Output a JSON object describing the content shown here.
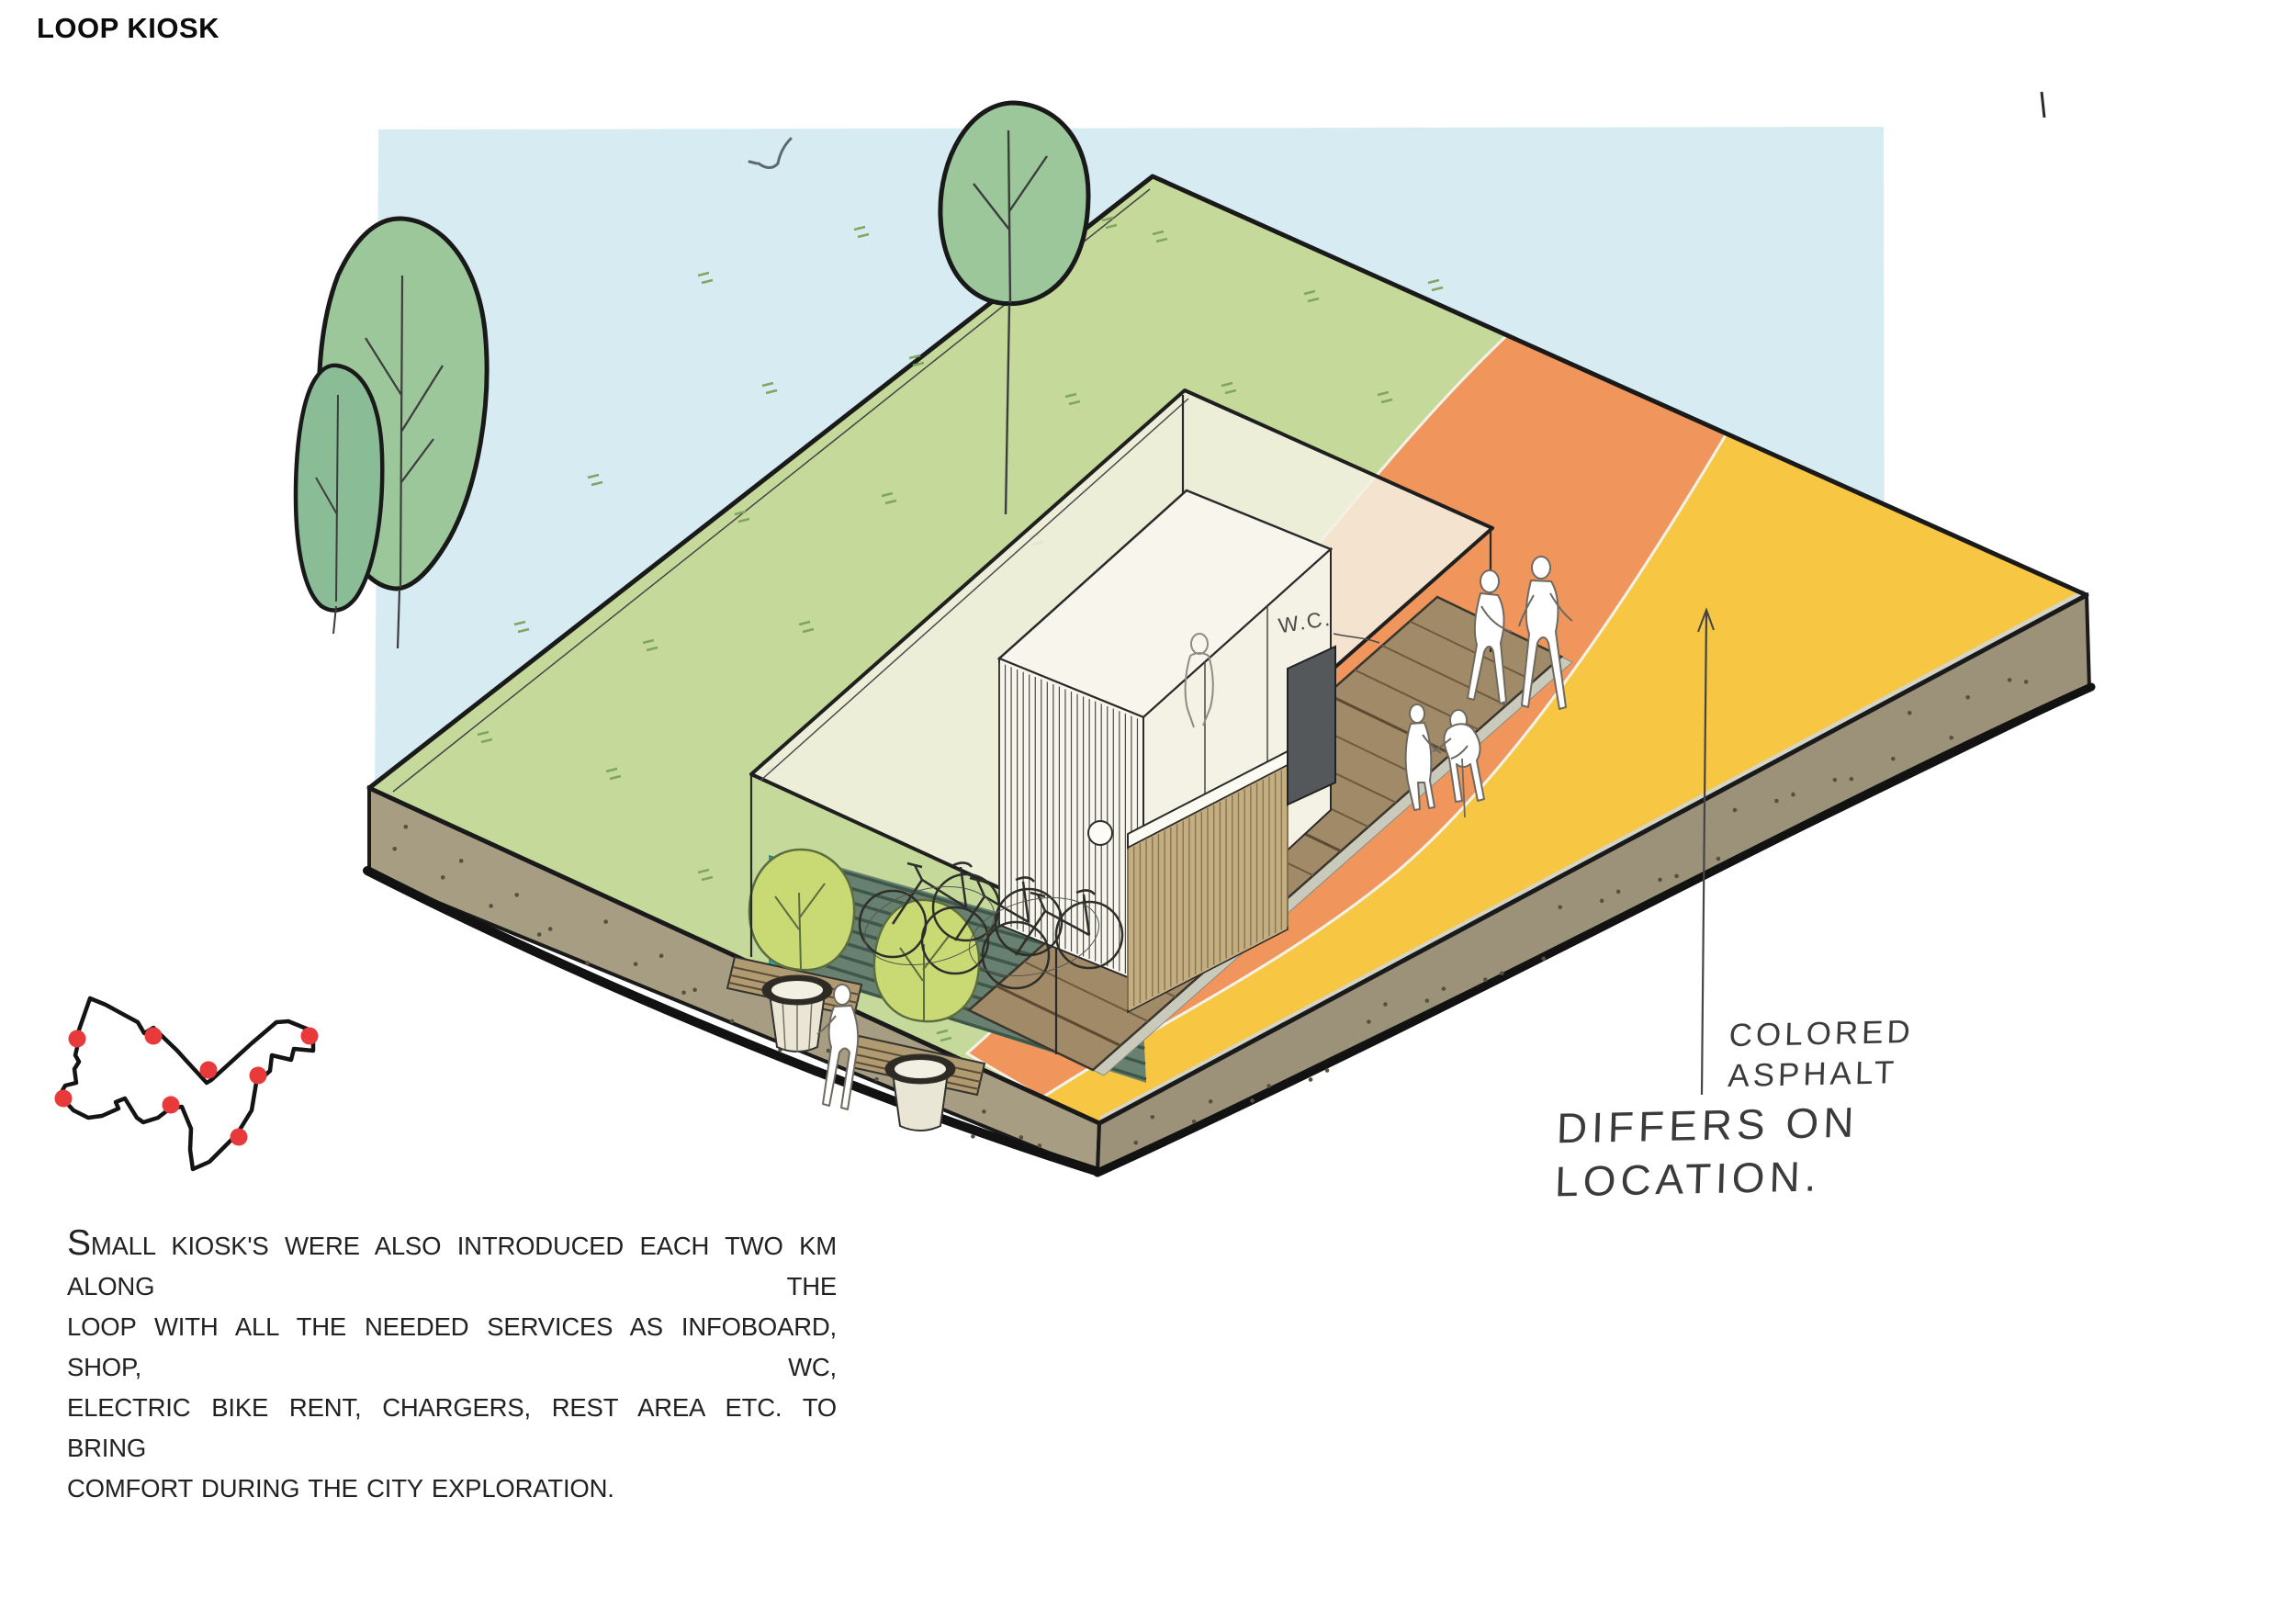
{
  "title": "LOOP KIOSK",
  "annotations": {
    "colored_line1": "COLORED",
    "colored_line2": "ASPHALT",
    "differs_line1": "DIFFERS ON",
    "differs_line2": "LOCATION.",
    "wc_label": "W.C."
  },
  "paragraph": {
    "lines": [
      "SMALL KIOSK'S WERE ALSO INTRODUCED EACH TWO KM ALONG THE",
      "LOOP WITH ALL THE NEEDED SERVICES AS INFOBOARD, SHOP, WC,",
      "ELECTRIC BIKE RENT, CHARGERS, REST AREA ETC. TO BRING",
      "COMFORT DURING THE CITY EXPLORATION."
    ]
  },
  "loop_map": {
    "stops": 8
  },
  "colors": {
    "sky": "#d7ecf2",
    "grass": "#c5da9a",
    "orange_path": "#f0965c",
    "yellow_path": "#f7c643",
    "soil_left": "#a79d82",
    "soil_right": "#9c927a",
    "tree": "#9cc79b",
    "tree_front": "#8abd96",
    "planter_tree": "#c9da74",
    "teal_panel": "#28a9b2",
    "deck": "#a18a67",
    "underdeck": "#68806f",
    "canopy": "#f3f1e3",
    "kiosk": "#f8f6ec",
    "tan_slats": "#c3ad82",
    "dark_panel": "#54585a",
    "loop_dot": "#e8393b"
  }
}
